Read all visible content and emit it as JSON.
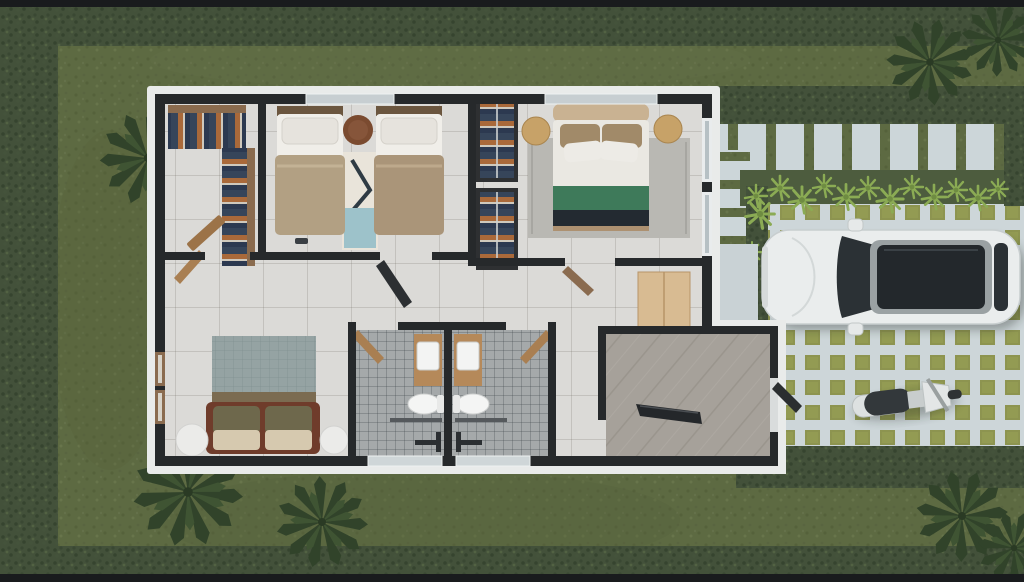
{
  "scene": {
    "kind": "top-down-3d-floorplan-render",
    "labels": {
      "house": "single-story-house-floorplan",
      "closet": "walk-in-closet",
      "bedroom1": "twin-bedroom",
      "bedroom2": "main-bedroom",
      "hallway": "hallway",
      "living": "living-area-with-sofa",
      "bath_left": "bathroom-left",
      "bath_right": "bathroom-right",
      "entry": "entry-foyer",
      "lawn": "grass-lawn",
      "hedge": "hedge-border",
      "palms": "palm-plants",
      "walkway": "back-paver-walkway",
      "sidepath": "side-paver-path",
      "fernbed": "fern-planting-bed",
      "driveway": "grass-grid-driveway",
      "porch": "entry-porch-pad",
      "car": "white-suv-top-view",
      "scooter": "gray-scooter-top-view"
    },
    "inventory": {
      "bedrooms": 2,
      "twin_beds": 2,
      "double_beds": 1,
      "bathrooms": 2,
      "toilets": 2,
      "sinks": 2,
      "wardrobes": 2,
      "sofas": 1,
      "vehicles": [
        "suv",
        "scooter"
      ]
    }
  },
  "palette": {
    "letterbox": "#191b1d",
    "grass": "#5d6a42",
    "grass_dark": "#55613b",
    "grass_light": "#68754b",
    "hedge": "#43513a",
    "hedge_dark": "#36442f",
    "palm": "#31432a",
    "fern": "#8bab54",
    "paver": "#ccd6d9",
    "grid_concrete": "#cdd6d9",
    "grid_grass": "#8d9450",
    "wall": "#26292b",
    "apron_white": "#e9ebea",
    "floor_tile": "#dbdad7",
    "bath_tile": "#a5a9aa",
    "entry_wood": "#a6a19a",
    "closet_wood": "#8a6b4e",
    "clothes_navy": "#36455a",
    "clothes_orange": "#a9693a",
    "bed_blanket_tan": "#b2a083",
    "pillow_white": "#edebe6",
    "pouf_brown": "#7b4b30",
    "rug_blue": "#9dc2ca",
    "headboard_tan": "#c9b292",
    "bed_green": "#3e7a5a",
    "bed_foot_dark": "#232a31",
    "side_pouf_tan": "#c7a268",
    "rug_gray": "#b9b8b3",
    "sofa_brown": "#6f3c2b",
    "pillow_olive": "#6e684c",
    "cushion_cream": "#d6c9af",
    "living_rug": "#8fa1a1",
    "vanity_wood": "#b5895a",
    "fixture_white": "#f3f4f3",
    "cabinet_wood": "#d8bb92",
    "car_body": "#eaeded",
    "car_glass": "#23282c",
    "scooter_body": "#dde1e1",
    "scooter_seat": "#33383b"
  }
}
